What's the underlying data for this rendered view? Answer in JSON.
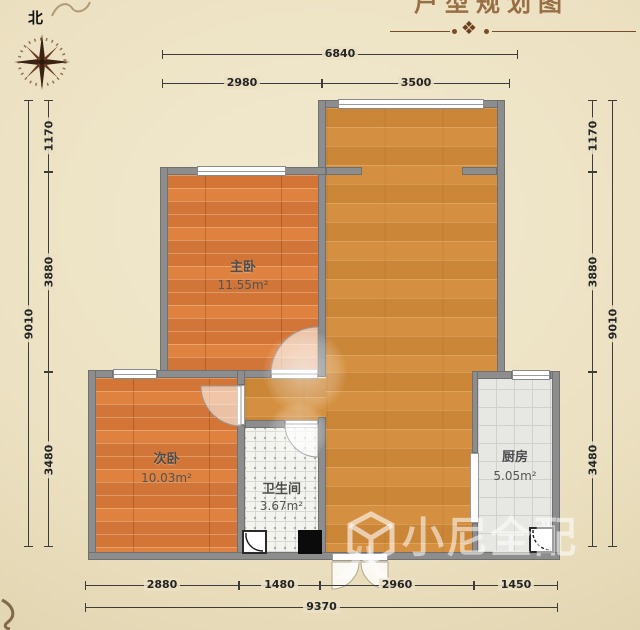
{
  "compass": {
    "label": "北"
  },
  "header": {
    "title_fragment": "户型规划图",
    "ornament_glyph": "❖"
  },
  "watermark": {
    "text": "小尼全配"
  },
  "rooms": {
    "master": {
      "name": "主卧",
      "area": "11.55m²"
    },
    "second": {
      "name": "次卧",
      "area": "10.03m²"
    },
    "bathroom": {
      "name": "卫生间",
      "area": "3.67m²"
    },
    "kitchen": {
      "name": "厨房",
      "area": "5.05m²"
    }
  },
  "dimensions": {
    "top": {
      "overall": "6840",
      "seg1": "2980",
      "seg2": "3500"
    },
    "left": {
      "overall": "9010",
      "seg1": "1170",
      "seg2": "3880",
      "seg3": "3480"
    },
    "right": {
      "overall": "9010",
      "seg1": "1170",
      "seg2": "3880",
      "seg3": "3480"
    },
    "bottom": {
      "overall": "9370",
      "seg1": "2880",
      "seg2": "1480",
      "seg3": "2960",
      "seg4": "1450"
    }
  },
  "colors": {
    "parchment": "#ece1c2",
    "wall_gray": "#8d8d8d",
    "bedroom_wood": "#dd8040",
    "living_wood": "#d18c3c",
    "bathroom_tile": "#f3f3ef",
    "kitchen_tile": "#e7e7e3",
    "dimension_text": "#242424",
    "ornament_brown": "#7b4a26"
  }
}
